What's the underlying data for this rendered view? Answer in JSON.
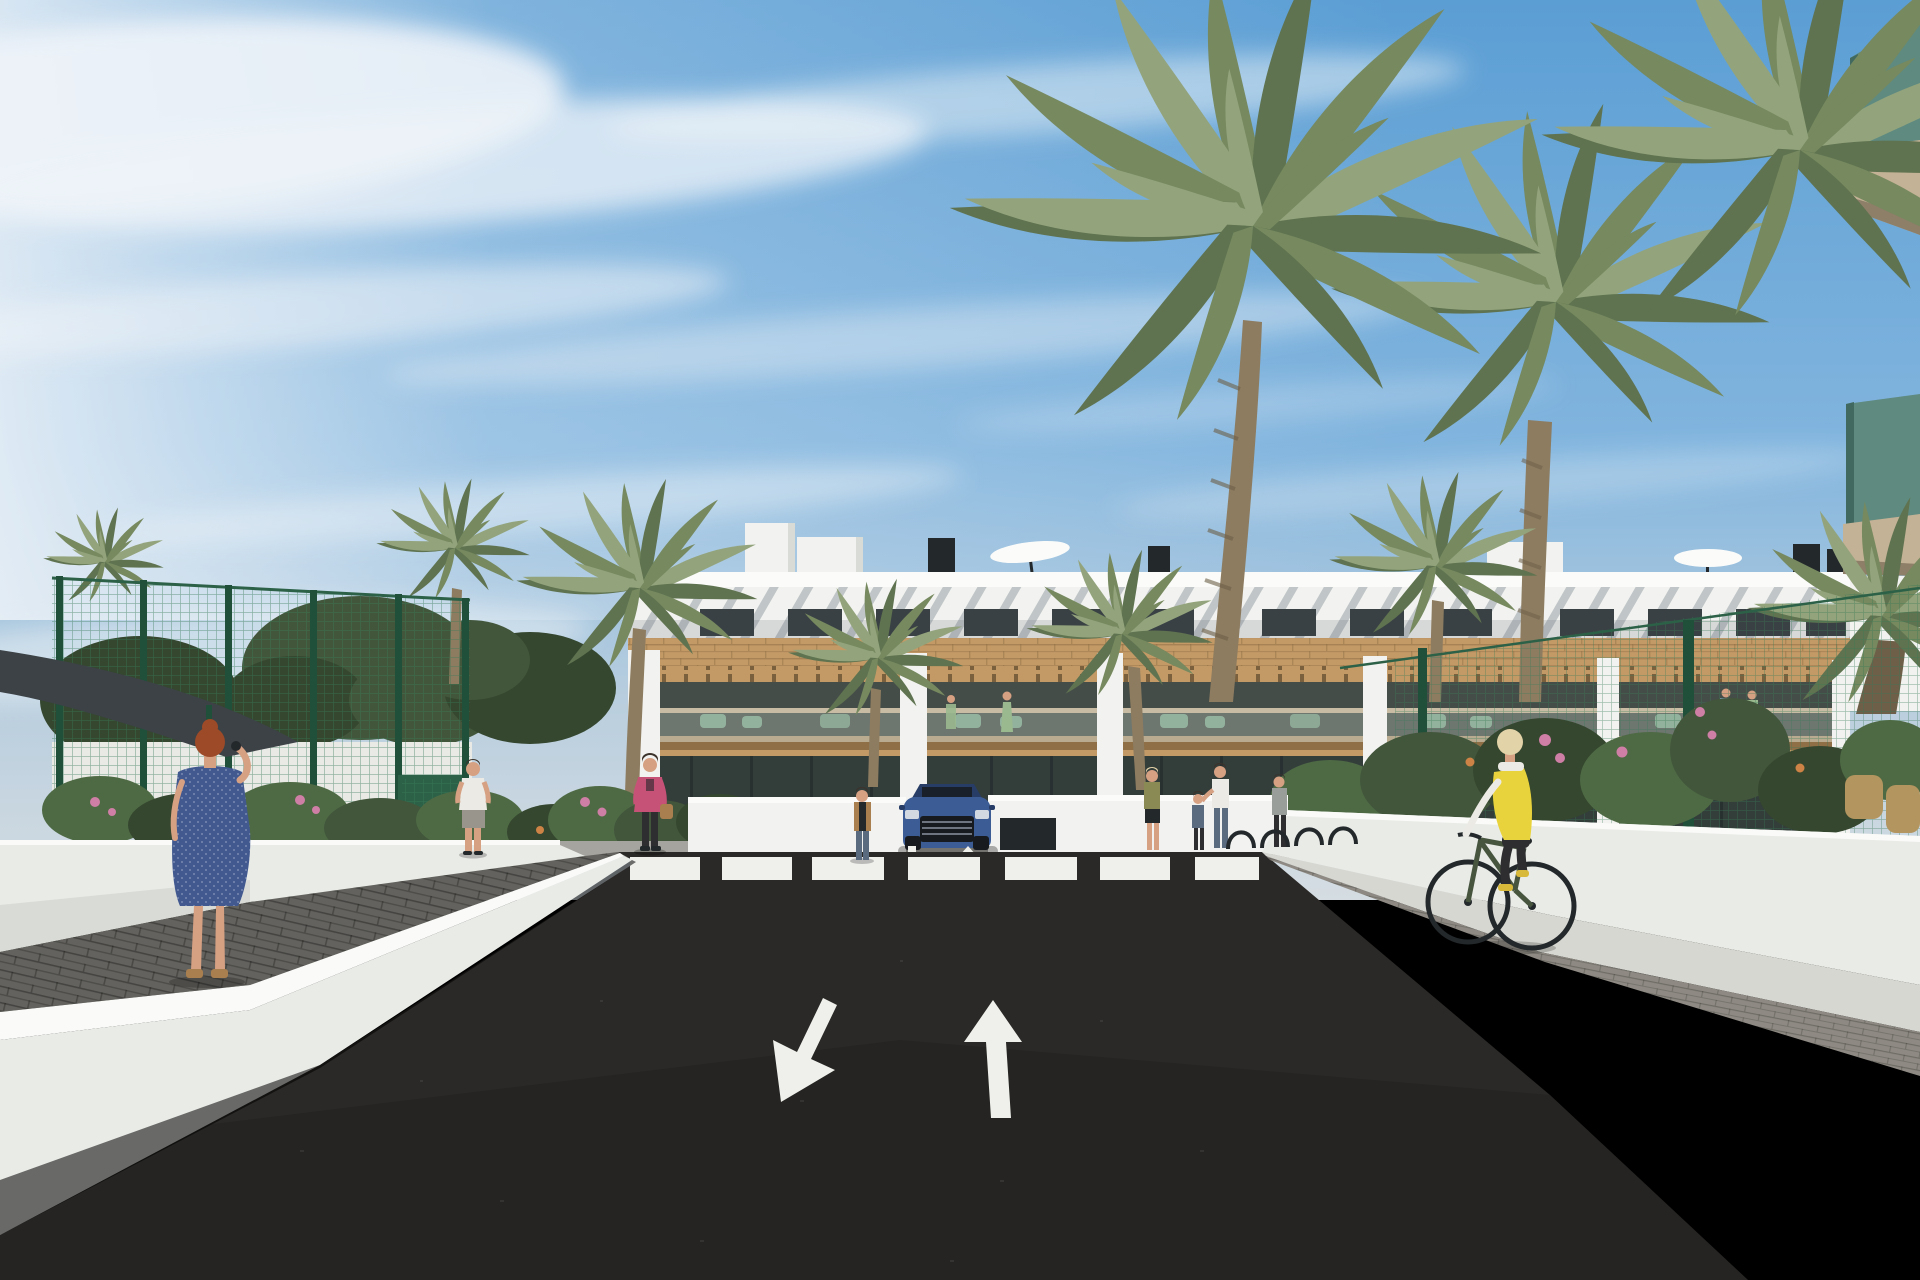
{
  "scene": {
    "description": "3D architectural rendering: modern white three-storey apartment complex with wood-clad balconies and rooftop parasols, tall palm trees, green sports-court fencing, gardens with pink and orange flowers, a dark asphalt access road with a zebra crosswalk, two painted lane arrows (one toward viewer, one away), a parked blue SUV, pedestrians on pale sidewalks and a blonde cyclist in a yellow vest riding a dark green bicycle"
  },
  "road_markings": {
    "crosswalk_stripes": 7,
    "lane_arrows": [
      "down-left toward viewer",
      "straight ahead"
    ],
    "driveway_arrows": [
      "down",
      "up"
    ]
  },
  "colors": {
    "sky_top": "#5b9ed4",
    "sky_mid": "#82b5de",
    "sky_low": "#b9cede",
    "sky_haze": "#d5dde2",
    "cloud_white": "#eef3f8",
    "building_white": "#f2f3f0",
    "building_bright": "#fbfcfa",
    "building_shade": "#d9dbd7",
    "slat_shadow": "#8d979e",
    "window_dark": "#3a4144",
    "frame_dark": "#23282b",
    "wood": "#c39a66",
    "wood_dark": "#8f6f45",
    "pergola_dark": "#6e5636",
    "interior_dark": "#454d48",
    "balcony_glass": "#b9c3bd",
    "rail_beige": "#c8bda4",
    "furniture_green": "#7fa98c",
    "ground_glass": "#333d3a",
    "road": "#2b2927",
    "road_dark": "#1f1e1d",
    "marking_white": "#eff0ec",
    "curb_white": "#e9ebe7",
    "curb_top": "#fafbf8",
    "curb_shade": "#c9ccc7",
    "paver_left": "#63625e",
    "walkway": "#d7d7d1",
    "paver_right": "#8e8a83",
    "fence_green": "#2c6148",
    "fence_post": "#20503a",
    "mesh_green": "#3a7a57",
    "palm_light": "#93a47c",
    "palm_mid": "#76895f",
    "palm_dark": "#5f7350",
    "palm_trunk": "#8d7c60",
    "palm_trunk_dark": "#6d5f48",
    "tree_green": "#42563b",
    "tree_dark": "#35472f",
    "bush_green": "#4e6a44",
    "flower_pink": "#cf7fa5",
    "flower_orange": "#cc8345",
    "sail_dark": "#3c4246",
    "car_blue": "#3c5c96",
    "car_roof": "#273d66",
    "car_dark": "#171b20",
    "car_light": "#d3d9e0",
    "skin": "#d6a083",
    "hair_red": "#9c4a28",
    "hair_dark": "#3c332c",
    "hair_blonde": "#e3d3a8",
    "dress_blue": "#41598f",
    "jacket_pink": "#c75277",
    "bag_tan": "#a97f4f",
    "shirt_white": "#eceae4",
    "shorts_grey": "#9a958c",
    "denim_blue": "#5a6b80",
    "vest_yellow": "#e9d33c",
    "pants_dark": "#2e2e30",
    "bike_green": "#47553f",
    "shoe_yellow": "#d8b93a",
    "glass_green": "#5f8a80",
    "glass_green_dark": "#41695f",
    "soffit_beige": "#c3b295",
    "soffit_dark": "#8d7f68",
    "rattan_tan": "#b3955f",
    "sage_green": "#8a8a54",
    "grey_top": "#9a9e9a"
  }
}
